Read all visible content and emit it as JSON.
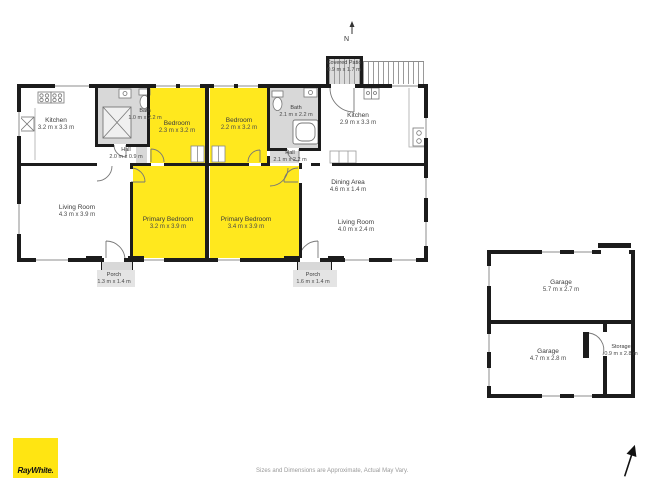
{
  "branding": {
    "logo_text": "RayWhite."
  },
  "disclaimer": {
    "text": "Sizes and Dimensions are Approximate, Actual May Vary."
  },
  "compass": {
    "north_label": "N"
  },
  "colors": {
    "brand_yellow": "#ffe512",
    "room_highlight_yellow": "#ffe81e",
    "wall_black": "#1c1c1c",
    "fixture_gray": "#d8d8d8"
  },
  "rooms": [
    {
      "name": "Kitchen",
      "dims": "3.2 m x 3.3 m"
    },
    {
      "name": "Bath",
      "dims": "1.0 m x 2.2 m"
    },
    {
      "name": "Hall",
      "dims": "2.0 m x 0.9 m"
    },
    {
      "name": "Bedroom",
      "dims": "2.3 m x 3.2 m"
    },
    {
      "name": "Bedroom",
      "dims": "2.2 m x 3.2 m"
    },
    {
      "name": "Bath",
      "dims": "2.1 m x 2.2 m"
    },
    {
      "name": "Kitchen",
      "dims": "2.9 m x 3.3 m"
    },
    {
      "name": "Hall",
      "dims": "2.1 m x 2.2 m"
    },
    {
      "name": "Living Room",
      "dims": "4.3 m x 3.9 m"
    },
    {
      "name": "Primary Bedroom",
      "dims": "3.2 m x 3.9 m"
    },
    {
      "name": "Primary Bedroom",
      "dims": "3.4 m x 3.9 m"
    },
    {
      "name": "Dining Area",
      "dims": "4.6 m x 1.4 m"
    },
    {
      "name": "Living Room",
      "dims": "4.0 m x 2.4 m"
    },
    {
      "name": "Porch",
      "dims": "1.3 m x 1.4 m"
    },
    {
      "name": "Porch",
      "dims": "1.6 m x 1.4 m"
    },
    {
      "name": "Covered Patio",
      "dims": "0.9 m x 1.7 m"
    },
    {
      "name": "Garage",
      "dims": "5.7 m x 2.7 m"
    },
    {
      "name": "Garage",
      "dims": "4.7 m x 2.8 m"
    },
    {
      "name": "Storage",
      "dims": "0.9 m x 2.8 m"
    }
  ]
}
